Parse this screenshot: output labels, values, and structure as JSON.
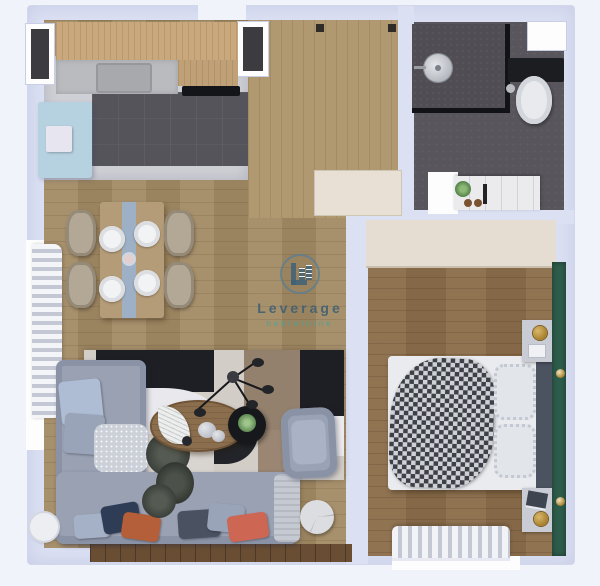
{
  "watermark": {
    "brand": "Leverage",
    "tagline": "nekretnine"
  },
  "palette": {
    "background": "#f1f3fb",
    "wall": "#dbe0f3",
    "wood_floor": "#a28a64",
    "hallway_floor": "#b09970",
    "bedroom_floor": "#8c6e4b",
    "kitchen_tile": "#55545a",
    "bathroom_floor": "#58565c",
    "cabinet_wood": "#c9a87d",
    "countertop_gray": "#b9bbbf",
    "fridge_island_blue": "#b6d1e0",
    "sofa_gray": "#99a1b3",
    "bedroom_accent_green": "#2e5c4b",
    "rug_black": "#1d1f24",
    "rug_taupe": "#94816d",
    "pillow_navy": "#2e3c55",
    "pillow_rust": "#b55f3a",
    "pillow_coral": "#cd6653",
    "lamp_gold": "#a8802f",
    "logo_blue": "#3f6277",
    "logo_teal": "#3ea89e"
  },
  "rooms": {
    "kitchen": {
      "label": "kitchen",
      "furniture": [
        "upper cabinets",
        "countertop",
        "sink",
        "cooktop",
        "fridge island"
      ]
    },
    "hallway": {
      "label": "entry hallway",
      "furniture": [
        "entry door",
        "closet"
      ]
    },
    "bathroom": {
      "label": "bathroom",
      "furniture": [
        "walk-in shower",
        "shower head",
        "toilet",
        "vanity",
        "plant"
      ]
    },
    "dining_area": {
      "label": "dining area",
      "furniture": [
        "dining table",
        "table runner",
        "4 chairs",
        "4 place settings",
        "window curtain"
      ]
    },
    "living_room": {
      "label": "living room",
      "furniture": [
        "L-shaped sofa",
        "throw pillows",
        "geometric rug",
        "coffee table",
        "round side table",
        "armchair",
        "spider floor lamp",
        "plant",
        "marble side table",
        "balcony strip"
      ]
    },
    "bedroom": {
      "label": "bedroom",
      "furniture": [
        "double bed",
        "patterned duvet",
        "ruffled pillows",
        "headboard",
        "2 nightstands",
        "gold lamps",
        "wardrobe",
        "window curtain",
        "green accent wall"
      ]
    }
  }
}
